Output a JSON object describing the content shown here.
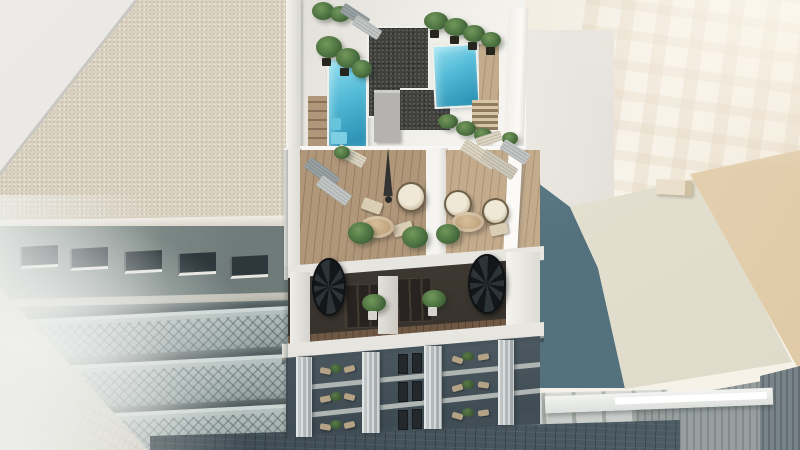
{
  "scene": {
    "type": "3d-architectural-render",
    "view": "aerial-birds-eye",
    "subject": "Modern white apartment building with two rooftop pools, wooden roof terraces with lounge furniture, recessed terraces with spiral staircases, glass balconies below, flanked by neighboring buildings over a dark cobblestone street",
    "objects": {
      "rooftop_pools": 2,
      "roof_terraces": 2,
      "spiral_staircases": 2,
      "hanging_egg_chairs": 3,
      "round_tables": 2,
      "sun_loungers": 8,
      "closed_parasol": 1,
      "balcony_floors_visible": 3
    }
  },
  "colors": {
    "sky1": "#efeade",
    "sky2": "#f7f2e8",
    "lroofSmooth": "#e8e6e2",
    "lroofEdge": "#c9c7c1",
    "lgravelBase": "#d8d0c0",
    "lgravelDot1": "#c3b9a4",
    "lgravelDot2": "#efe9da",
    "lfacade1": "#97a19c",
    "lfacade2": "#6e7b79",
    "lwin": "#2e383c",
    "lsill": "#e9e7e1",
    "lbalc1": "#b5c1bf",
    "lbalc2": "#93a2a0",
    "paveBase": "#cbc5b8",
    "haze": "#eff0ee",
    "street1": "#37444c",
    "street2": "#51606a",
    "mwhite": "#e9e7e1",
    "mwhiteHi": "#f8f7f3",
    "mwhiteLo": "#d5d3cc",
    "pool1": "#93dff0",
    "pool2": "#52b9d6",
    "pool3": "#2f94b6",
    "poolEdge": "#eef0ec",
    "dgravelBase": "#42423f",
    "dgravelDot1": "#5f5f5a",
    "dgravelDot2": "#28282a",
    "bulkLow": "#b5b3af",
    "wood1": "#b1977a",
    "wood2": "#c4ab8c",
    "plantMain": "#4c7140",
    "plantDk": "#2f4a2a",
    "plantLt": "#73985c",
    "potDk": "#26261f",
    "lounGray1": "#98a1a3",
    "lounGray2": "#c2c6c5",
    "lounBeige": "#ddd5c2",
    "umb": "#343432",
    "eggFrame": "#6f6049",
    "egg1": "#efe8d6",
    "egg2": "#a59a83",
    "tab1": "#d8bf9a",
    "tab2": "#b2936c",
    "cushion": "#d9cdb4",
    "interior1": "#6b645c",
    "interior2": "#2e2a24",
    "doorDk": "#282320",
    "floorWood": "#6f5945",
    "stair1": "#14171a",
    "stair2": "#2d3438",
    "ledge1": "#f6f5f2",
    "ledge2": "#e2e0da",
    "lowbg1": "#5f6c74",
    "lowbg2": "#3f4c54",
    "glassHi": "#829198",
    "glassLo": "#3a464e",
    "pierC1": "#c9cfce",
    "pierC2": "#9aa2a3",
    "furnBeige": "#b3a286",
    "darkWin": "#23282c",
    "brightWall1": "#f2ece1",
    "brightWall2": "#f8f3e9",
    "teal1": "#7b98a2",
    "teal2": "#54727e",
    "cream1": "#eae6d8",
    "cream2": "#dedac9",
    "beige1": "#efe3cc",
    "beige2": "#dfc9a5",
    "chimney": "#e9dfcb",
    "shop1": "#c3c7c2",
    "shop2": "#a8aea9",
    "conc1": "#98a09f",
    "conc2": "#79848a",
    "skylight": "#ffffff"
  }
}
